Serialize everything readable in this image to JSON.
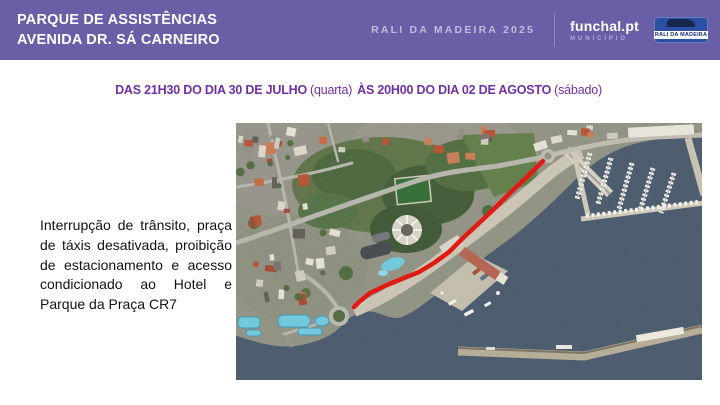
{
  "header": {
    "background": "#6A5EA6",
    "location_line1": "PARQUE DE ASSISTÊNCIAS",
    "location_line2": "AVENIDA DR. SÁ CARNEIRO",
    "event_title": "RALI DA MADEIRA 2025",
    "municipality": {
      "name": "funchal.pt",
      "subtitle": "MUNICÍPIO"
    },
    "badge_text": "RALI DA MADEIRA"
  },
  "schedule": {
    "part1_bold": "DAS 21H30 DO DIA 30 DE JULHO",
    "part1_normal": "(quarta)",
    "part2_bold": "ÀS 20H00 DO DIA 02 DE AGOSTO",
    "part2_normal": "(sábado)",
    "text_color": "#7030A0"
  },
  "description": {
    "text": "Interrupção de trânsito, praça de táxis desativada, proibição de estacionamento e acesso condicionado ao Hotel e Parque da Praça CR7"
  },
  "map": {
    "kind": "satellite view of Funchal seafront with closed section highlighted",
    "route_color": "#E31109",
    "route_width": 4.5,
    "route_points": [
      [
        307,
        38
      ],
      [
        291,
        54
      ],
      [
        274,
        70
      ],
      [
        257,
        87
      ],
      [
        241,
        102
      ],
      [
        227,
        115
      ],
      [
        213,
        129
      ],
      [
        198,
        140
      ],
      [
        183,
        149
      ],
      [
        168,
        155
      ],
      [
        151,
        162
      ],
      [
        134,
        170
      ],
      [
        123,
        179
      ],
      [
        118,
        184
      ]
    ],
    "colors": {
      "sea": "#47586B",
      "urban": "#8F9282",
      "vegetation": "#50693E",
      "quay": "#CBC5B5",
      "road": "#B6B6AC",
      "pool": "#6FC8DE",
      "building_orange": [
        "#B5512F",
        "#C2683D",
        "#A4452E",
        "#C97B52"
      ],
      "building_light": [
        "#DCD8CC",
        "#CFCCC2",
        "#E6E2D6"
      ],
      "building_dark": [
        "#8F8C84",
        "#75726B",
        "#5E5B55"
      ]
    }
  }
}
